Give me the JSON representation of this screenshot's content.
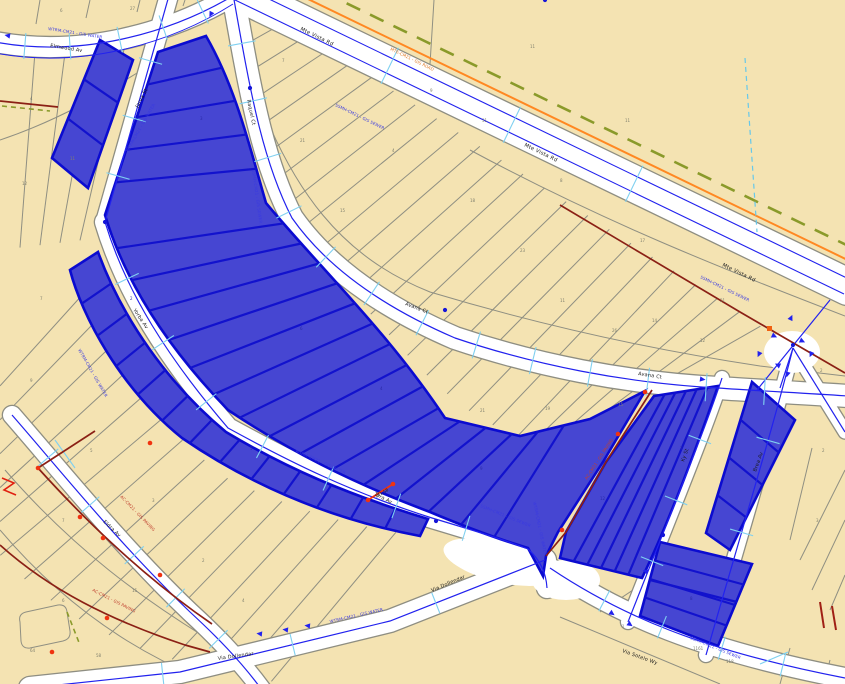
{
  "map": {
    "title": "Parcel selection map view",
    "street_names": {
      "elmwood": "Elmwood Av",
      "jarva": "Jarva St",
      "raquel": "Raquel Ct",
      "avana": "Avana Ct",
      "mte_vista": "Mte Vista Rd",
      "yorba": "Yorba Av",
      "tora": "Tora Av",
      "eldra": "Eldra Av",
      "ky": "Ky St",
      "brea": "Brea Av",
      "dollendar": "Via Dollendar",
      "sotelo": "Via Sotelo Wy"
    },
    "annotations": [
      {
        "t": "WTRM-CM21 - GIS WATER",
        "x": 48,
        "y": 30,
        "r": 9,
        "c": "blue"
      },
      {
        "t": "SSMH-CM21 - GIS SEWER",
        "x": 335,
        "y": 106,
        "r": 26,
        "c": "blue"
      },
      {
        "t": "SSMH-CM21 - GIS SEWER",
        "x": 700,
        "y": 278,
        "r": 26,
        "c": "blue"
      },
      {
        "t": "WTRM-CM21 - GIS WATER",
        "x": 128,
        "y": 152,
        "r": -60,
        "c": "blue"
      },
      {
        "t": "WTRM-CM21 - GIS WATER",
        "x": 295,
        "y": 452,
        "r": 24,
        "c": "blue"
      },
      {
        "t": "WTRM-CM21 - GIS WATER",
        "x": 330,
        "y": 623,
        "r": -13,
        "c": "blue"
      },
      {
        "t": "SSMH-CM21 - GIS SEWER",
        "x": 690,
        "y": 639,
        "r": 22,
        "c": "blue"
      },
      {
        "t": "WTRM-CM21 - GIS WATER",
        "x": 533,
        "y": 502,
        "r": 78,
        "c": "blue"
      },
      {
        "t": "SSMH-CM21 - GIS SEWER",
        "x": 480,
        "y": 507,
        "r": 22,
        "c": "blue"
      },
      {
        "t": "WTRM-CM21 - GIS WATER",
        "x": 78,
        "y": 350,
        "r": 60,
        "c": "blue"
      },
      {
        "t": "SSMH-CM21 - GIS SEWER",
        "x": 252,
        "y": 170,
        "r": 82,
        "c": "blue"
      },
      {
        "t": "AC-CM21 - GIS PAVING",
        "x": 120,
        "y": 497,
        "r": 46,
        "c": "red"
      },
      {
        "t": "AC-CM21 - GIS PAVING",
        "x": 92,
        "y": 591,
        "r": 27,
        "c": "red"
      },
      {
        "t": "AC-CM21 - GIS PAVING",
        "x": 587,
        "y": 480,
        "r": -57,
        "c": "red"
      },
      {
        "t": "MTE-CM21 - GIS ROAD",
        "x": 390,
        "y": 50,
        "r": 26,
        "c": "orange"
      }
    ],
    "parcel_numbers": [
      {
        "t": "4",
        "x": 30,
        "y": 100
      },
      {
        "t": "11",
        "x": 70,
        "y": 160
      },
      {
        "t": "12",
        "x": 22,
        "y": 185
      },
      {
        "t": "6",
        "x": 60,
        "y": 12
      },
      {
        "t": "27",
        "x": 130,
        "y": 10
      },
      {
        "t": "7",
        "x": 282,
        "y": 62
      },
      {
        "t": "21",
        "x": 300,
        "y": 142
      },
      {
        "t": "15",
        "x": 340,
        "y": 212
      },
      {
        "t": "4",
        "x": 392,
        "y": 152
      },
      {
        "t": "9",
        "x": 430,
        "y": 92
      },
      {
        "t": "18",
        "x": 470,
        "y": 202
      },
      {
        "t": "23",
        "x": 520,
        "y": 252
      },
      {
        "t": "11",
        "x": 560,
        "y": 302
      },
      {
        "t": "26",
        "x": 612,
        "y": 332
      },
      {
        "t": "14",
        "x": 652,
        "y": 322
      },
      {
        "t": "12",
        "x": 700,
        "y": 342
      },
      {
        "t": "31",
        "x": 482,
        "y": 122
      },
      {
        "t": "8",
        "x": 560,
        "y": 182
      },
      {
        "t": "17",
        "x": 640,
        "y": 242
      },
      {
        "t": "21",
        "x": 720,
        "y": 302
      },
      {
        "t": "21",
        "x": 480,
        "y": 412
      },
      {
        "t": "19",
        "x": 545,
        "y": 410
      },
      {
        "t": "15",
        "x": 618,
        "y": 406
      },
      {
        "t": "11",
        "x": 530,
        "y": 48
      },
      {
        "t": "11",
        "x": 625,
        "y": 122
      },
      {
        "t": "7",
        "x": 40,
        "y": 300
      },
      {
        "t": "9",
        "x": 30,
        "y": 382
      },
      {
        "t": "5",
        "x": 90,
        "y": 452
      },
      {
        "t": "3",
        "x": 152,
        "y": 502
      },
      {
        "t": "7",
        "x": 62,
        "y": 522
      },
      {
        "t": "15",
        "x": 132,
        "y": 592
      },
      {
        "t": "6",
        "x": 62,
        "y": 602
      },
      {
        "t": "2",
        "x": 202,
        "y": 562
      },
      {
        "t": "4",
        "x": 242,
        "y": 602
      },
      {
        "t": "64",
        "x": 30,
        "y": 652
      },
      {
        "t": "58",
        "x": 96,
        "y": 657
      },
      {
        "t": "2",
        "x": 820,
        "y": 372
      },
      {
        "t": "2",
        "x": 822,
        "y": 452
      },
      {
        "t": "3",
        "x": 816,
        "y": 522
      },
      {
        "t": "1161",
        "x": 693,
        "y": 650
      },
      {
        "t": "118",
        "x": 726,
        "y": 663
      },
      {
        "t": "1",
        "x": 622,
        "y": 628
      }
    ],
    "selected_parcel_numbers": [
      {
        "t": "3",
        "x": 200,
        "y": 120
      },
      {
        "t": "2",
        "x": 130,
        "y": 300
      },
      {
        "t": "6",
        "x": 300,
        "y": 330
      },
      {
        "t": "4",
        "x": 380,
        "y": 390
      },
      {
        "t": "9",
        "x": 480,
        "y": 470
      },
      {
        "t": "12",
        "x": 600,
        "y": 500
      },
      {
        "t": "7",
        "x": 680,
        "y": 450
      },
      {
        "t": "5",
        "x": 250,
        "y": 450
      },
      {
        "t": "8",
        "x": 690,
        "y": 600
      }
    ],
    "measure_label": "141.58",
    "colors": {
      "parcel_fill": "#f4e3b2",
      "selection_fill": "#4646d2",
      "selection_border": "#0b0bd0",
      "selection_division": "#1212cd",
      "street_casing": "#8e8e82",
      "parcel_line": "#8f8f82",
      "centerline": "#2222ee",
      "water_tick": "#7fd0f0",
      "edge_orange": "#ff8822",
      "dashed_olive": "#8a9a2a",
      "utility_red": "#8b2015",
      "node_red": "#f03310",
      "number_gray": "#80806e",
      "number_blue": "#2a2aa8",
      "annot_blue": "#3a3ae0",
      "annot_red": "#c04030",
      "annot_orange": "#e07820"
    }
  }
}
